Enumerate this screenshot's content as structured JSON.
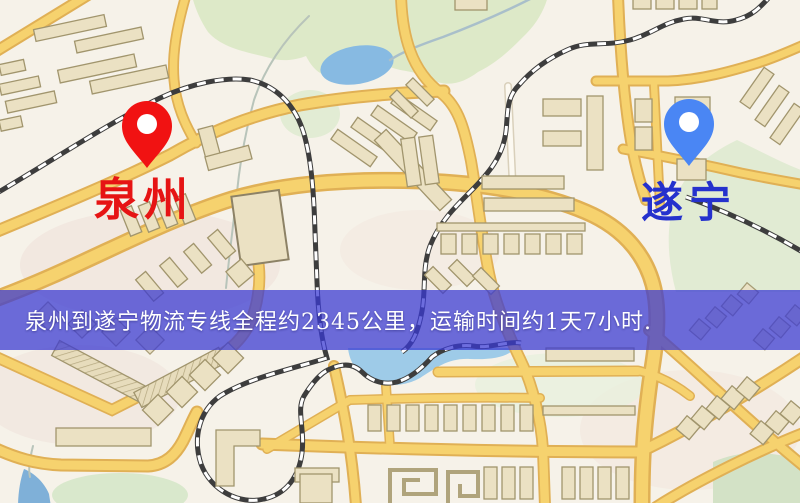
{
  "map": {
    "style": "street-map",
    "colors": {
      "background": "#f6f2e9",
      "road_fill": "#f6d26e",
      "road_casing": "#e0b055",
      "building_fill": "#ebe1c3",
      "park_green": "#dde9c8",
      "water_blue": "#87bae2",
      "railway_dark": "#3d3d3d"
    }
  },
  "markers": {
    "origin": {
      "label": "泉州",
      "pin_color": "#f11212",
      "label_color": "#e61414"
    },
    "destination": {
      "label": "遂宁",
      "pin_color": "#4a86f4",
      "label_color": "#2531cd"
    }
  },
  "banner": {
    "text": "泉州到遂宁物流专线全程约2345公里，运输时间约1天7小时.",
    "bg_color": "rgba(58,58,210,0.74)",
    "text_color": "#ffffff",
    "route": {
      "origin": "泉州",
      "destination": "遂宁",
      "distance_text": "约2345公里",
      "duration_text": "约1天7小时"
    }
  }
}
